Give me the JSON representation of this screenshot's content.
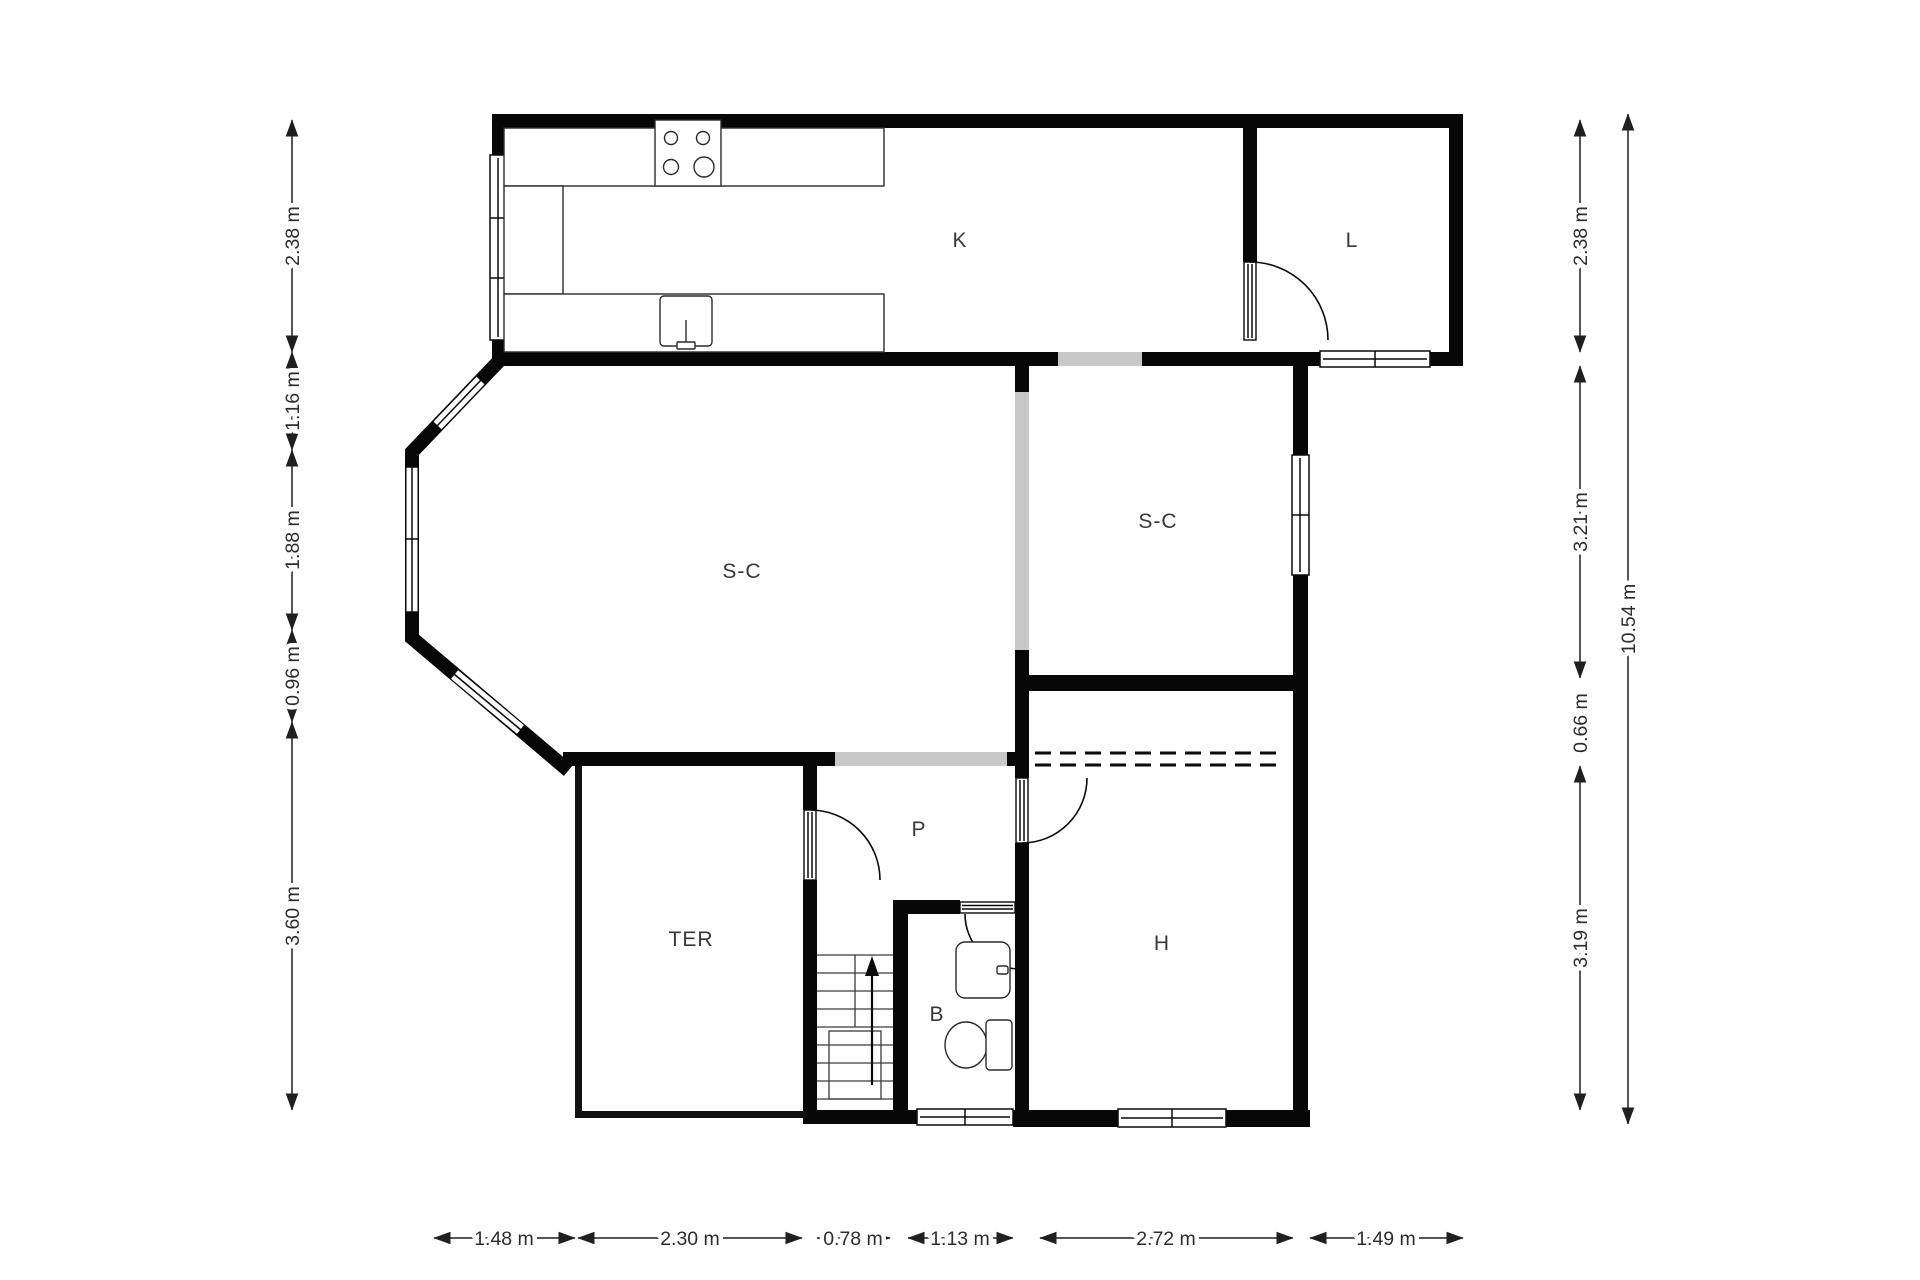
{
  "floor_plan": {
    "rooms": {
      "k": {
        "label": "K"
      },
      "l": {
        "label": "L"
      },
      "sc_left": {
        "label": "S-C"
      },
      "sc_right": {
        "label": "S-C"
      },
      "p": {
        "label": "P"
      },
      "ter": {
        "label": "TER"
      },
      "b": {
        "label": "B"
      },
      "h": {
        "label": "H"
      }
    },
    "dims": {
      "left": [
        "2.38 m",
        "1.16 m",
        "1.88 m",
        "0.96 m",
        "3.60 m"
      ],
      "right": [
        "2.38 m",
        "3.21 m",
        "0.66 m",
        "3.19 m"
      ],
      "overall": "10.54 m",
      "bottom": [
        "1.48 m",
        "2.30 m",
        "0.78 m",
        "1.13 m",
        "2.72 m",
        "1.49 m"
      ]
    },
    "colors": {
      "wall": "#070707",
      "opening": "#c8c8c8",
      "background": "#ffffff",
      "text": "#2d2d2d"
    }
  }
}
